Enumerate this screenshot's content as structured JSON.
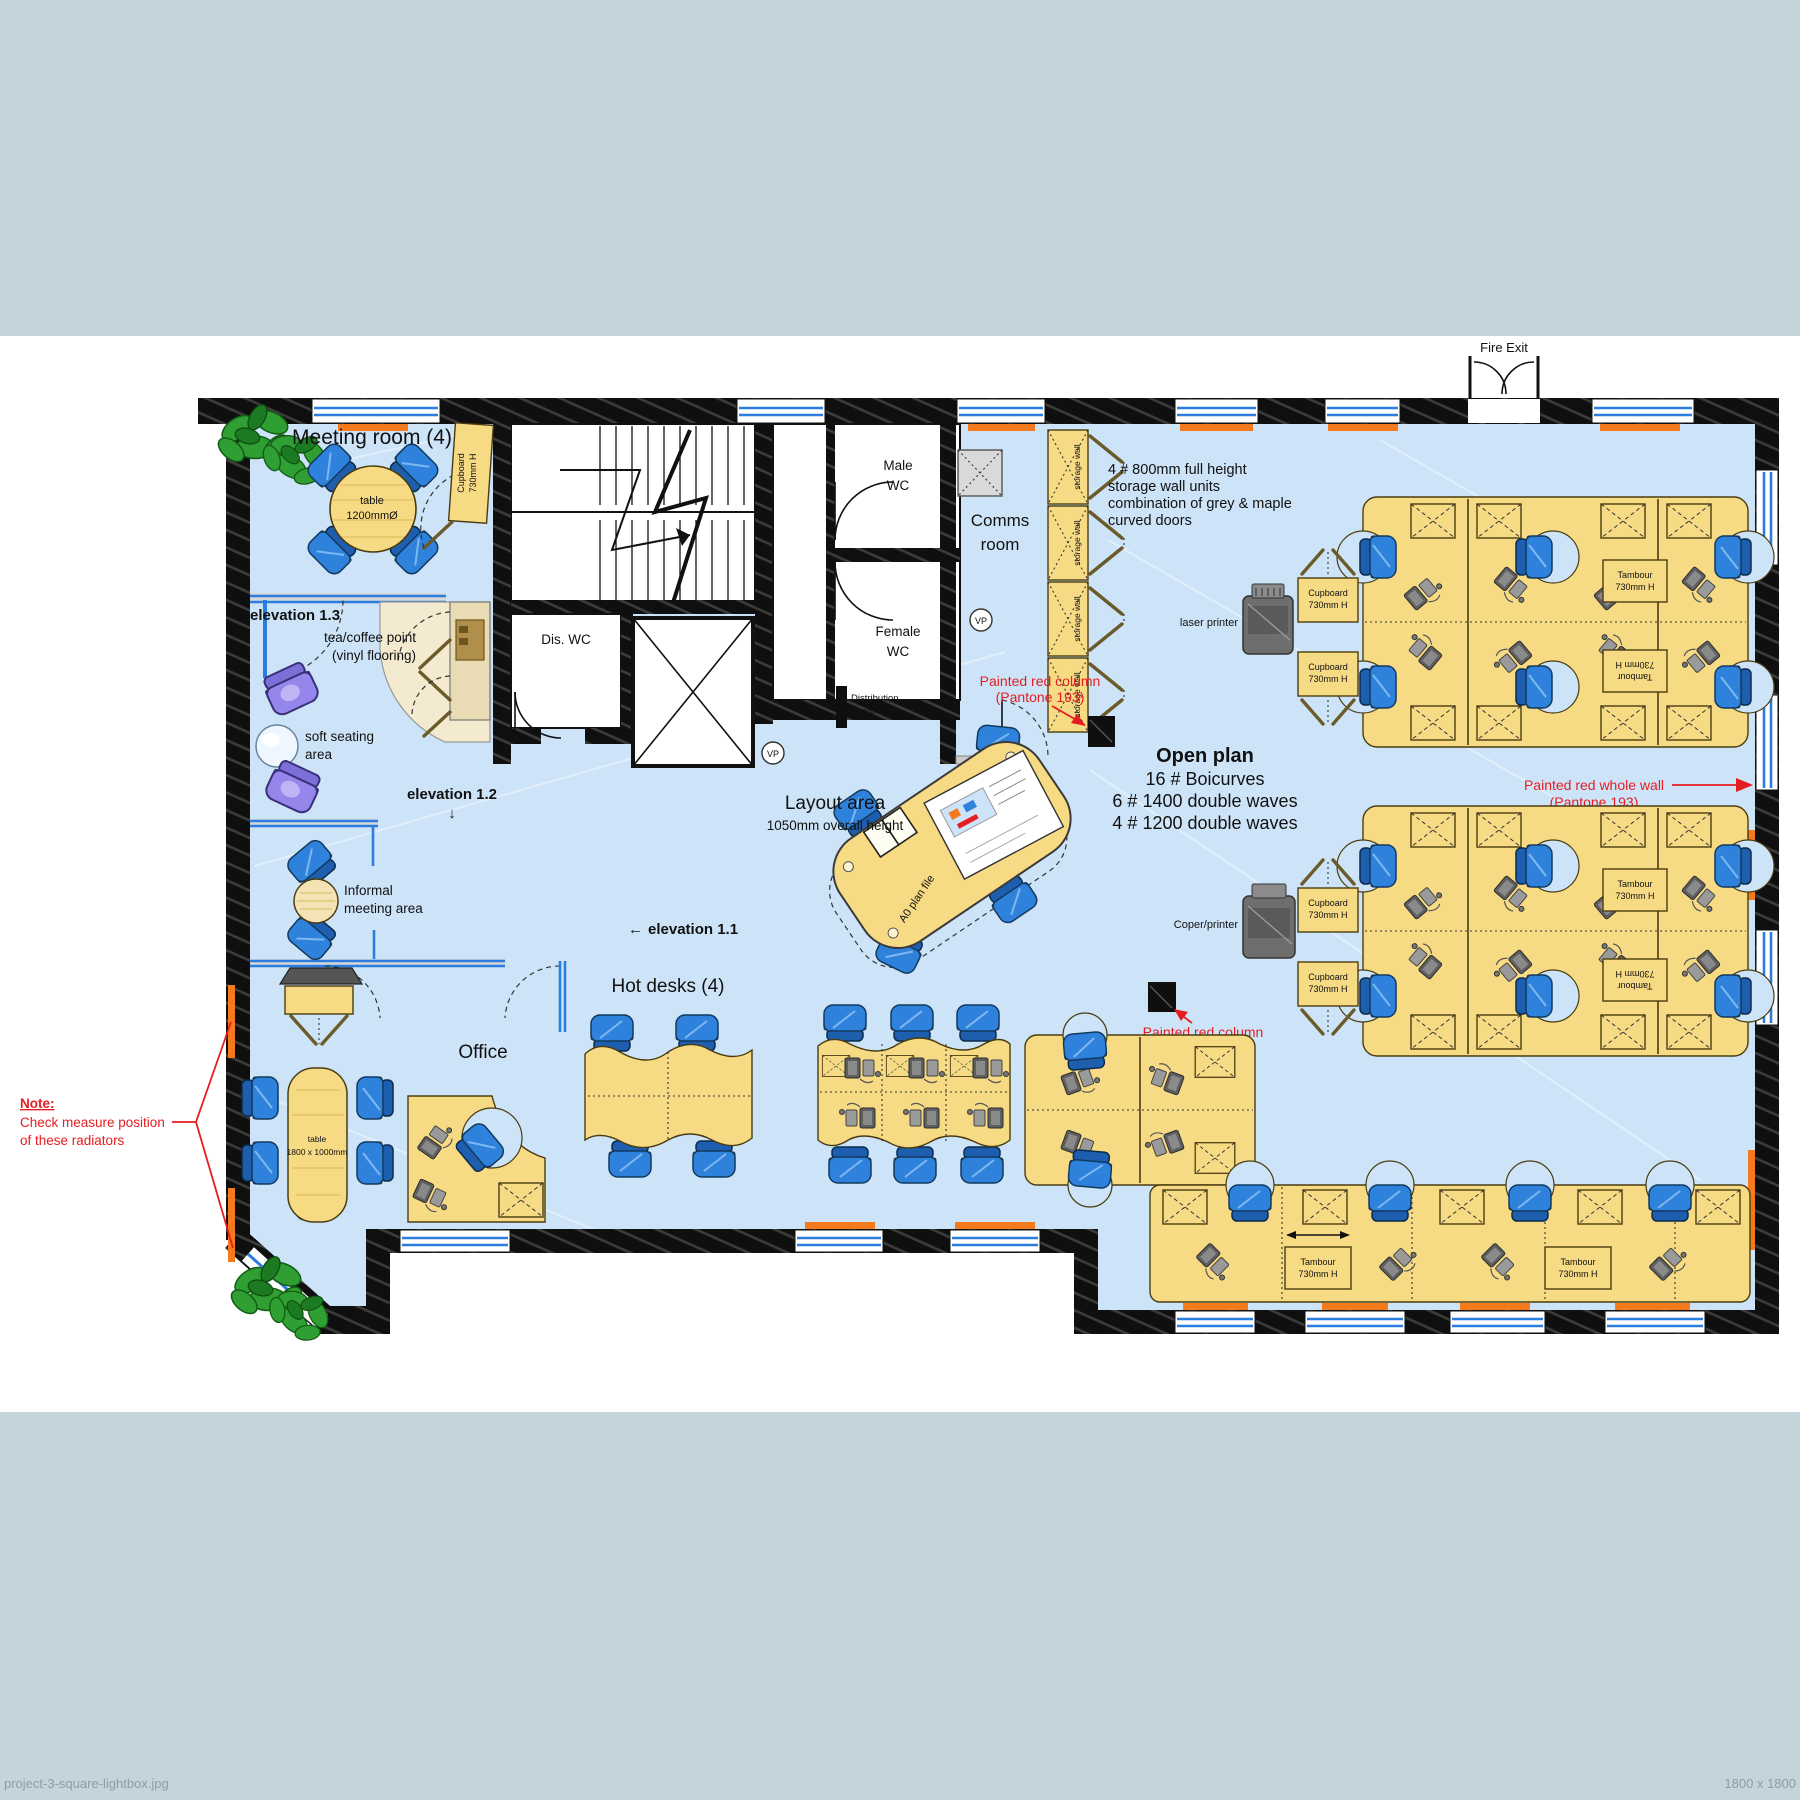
{
  "meta": {
    "filename": "project-3-square-lightbox.jpg",
    "dimensions_label": "1800 x 1800"
  },
  "colors": {
    "band": "#c5d4da",
    "floor": "#cde4f8",
    "wall": "#0f0f0f",
    "desk": "#f7da84",
    "chair_blue": "#2f82dc",
    "sofa_purple": "#9486ea",
    "radiator_orange": "#f5791d",
    "glazing_blue": "#2b7de0",
    "annotation_red": "#e51d20",
    "vinyl_cream": "#f3ead0",
    "plant_green": "#2f9e33"
  },
  "icons": {
    "arrow_left": "←",
    "arrow_down": "↓"
  },
  "labels": {
    "fire_exit": "Fire Exit",
    "meeting_room": "Meeting room (4)",
    "meeting_table_1": "table",
    "meeting_table_2": "1200mmØ",
    "cupboard_1": "Cupboard",
    "cupboard_2": "730mm H",
    "tambour_1": "Tambour",
    "tambour_2": "730mm H",
    "elevation_13": "elevation 1.3",
    "tea_point_1": "tea/coffee point",
    "tea_point_2": "(vinyl flooring)",
    "soft_seating_1": "soft seating",
    "soft_seating_2": "area",
    "elevation_12": "elevation 1.2",
    "informal_1": "Informal",
    "informal_2": "meeting area",
    "tv_screen": "TV screen",
    "office": "Office",
    "office_table_1": "table",
    "office_table_2": "1800 x 1000mm",
    "note_1": "Note:",
    "note_2": "Check measure position",
    "note_3": "of these radiators",
    "hot_desks": "Hot desks (4)",
    "elevation_11": "elevation 1.1",
    "layout_1": "Layout area",
    "layout_2": "1050mm overall height",
    "a0_plan_file": "A0 plan file",
    "dis_wc": "Dis. WC",
    "male_wc_1": "Male",
    "male_wc_2": "WC",
    "female_wc_1": "Female",
    "female_wc_2": "WC",
    "comms_1": "Comms",
    "comms_2": "room",
    "distribution_1": "Distribution",
    "distribution_2": "board",
    "vp": "VP",
    "storage_callout_1": "4 # 800mm full height",
    "storage_callout_2": "storage wall units",
    "storage_callout_3": "combination of grey & maple",
    "storage_callout_4": "curved doors",
    "storage_wall": "storage wall",
    "painted_column_1": "Painted red column",
    "painted_column_2": "(Pantone 193)",
    "painted_wall_1": "Painted red whole wall",
    "painted_wall_2": "(Pantone 193)",
    "open_plan_1": "Open plan",
    "open_plan_2": "16 # Boicurves",
    "open_plan_3": "6 # 1400 double waves",
    "open_plan_4": "4 # 1200 double waves",
    "laser_printer": "laser printer",
    "copier_printer": "Coper/printer"
  }
}
